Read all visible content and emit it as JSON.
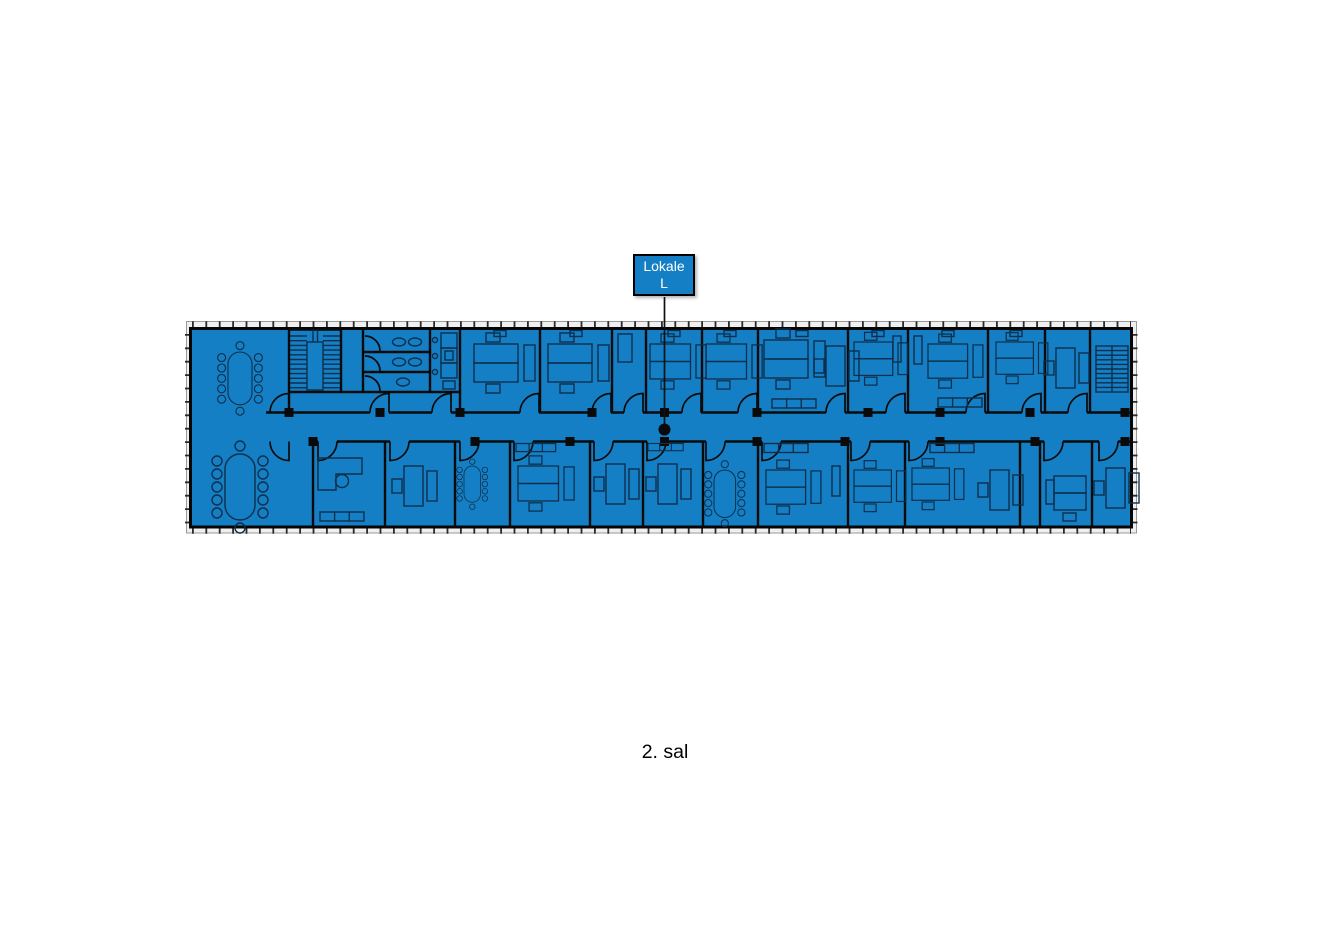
{
  "floor_plan": {
    "caption": "2. sal",
    "marker": {
      "label_line1": "Lokale",
      "label_line2": "L"
    },
    "colors": {
      "plan_fill": "#147fc4",
      "wall": "#0a0a0a",
      "furniture_line": "#0e2f4c",
      "label_box_fill": "#147fc4",
      "label_box_border": "#000000",
      "label_text": "#ffffff",
      "facade_band": "#efefef",
      "marker_dot": "#0a0a0a"
    }
  }
}
